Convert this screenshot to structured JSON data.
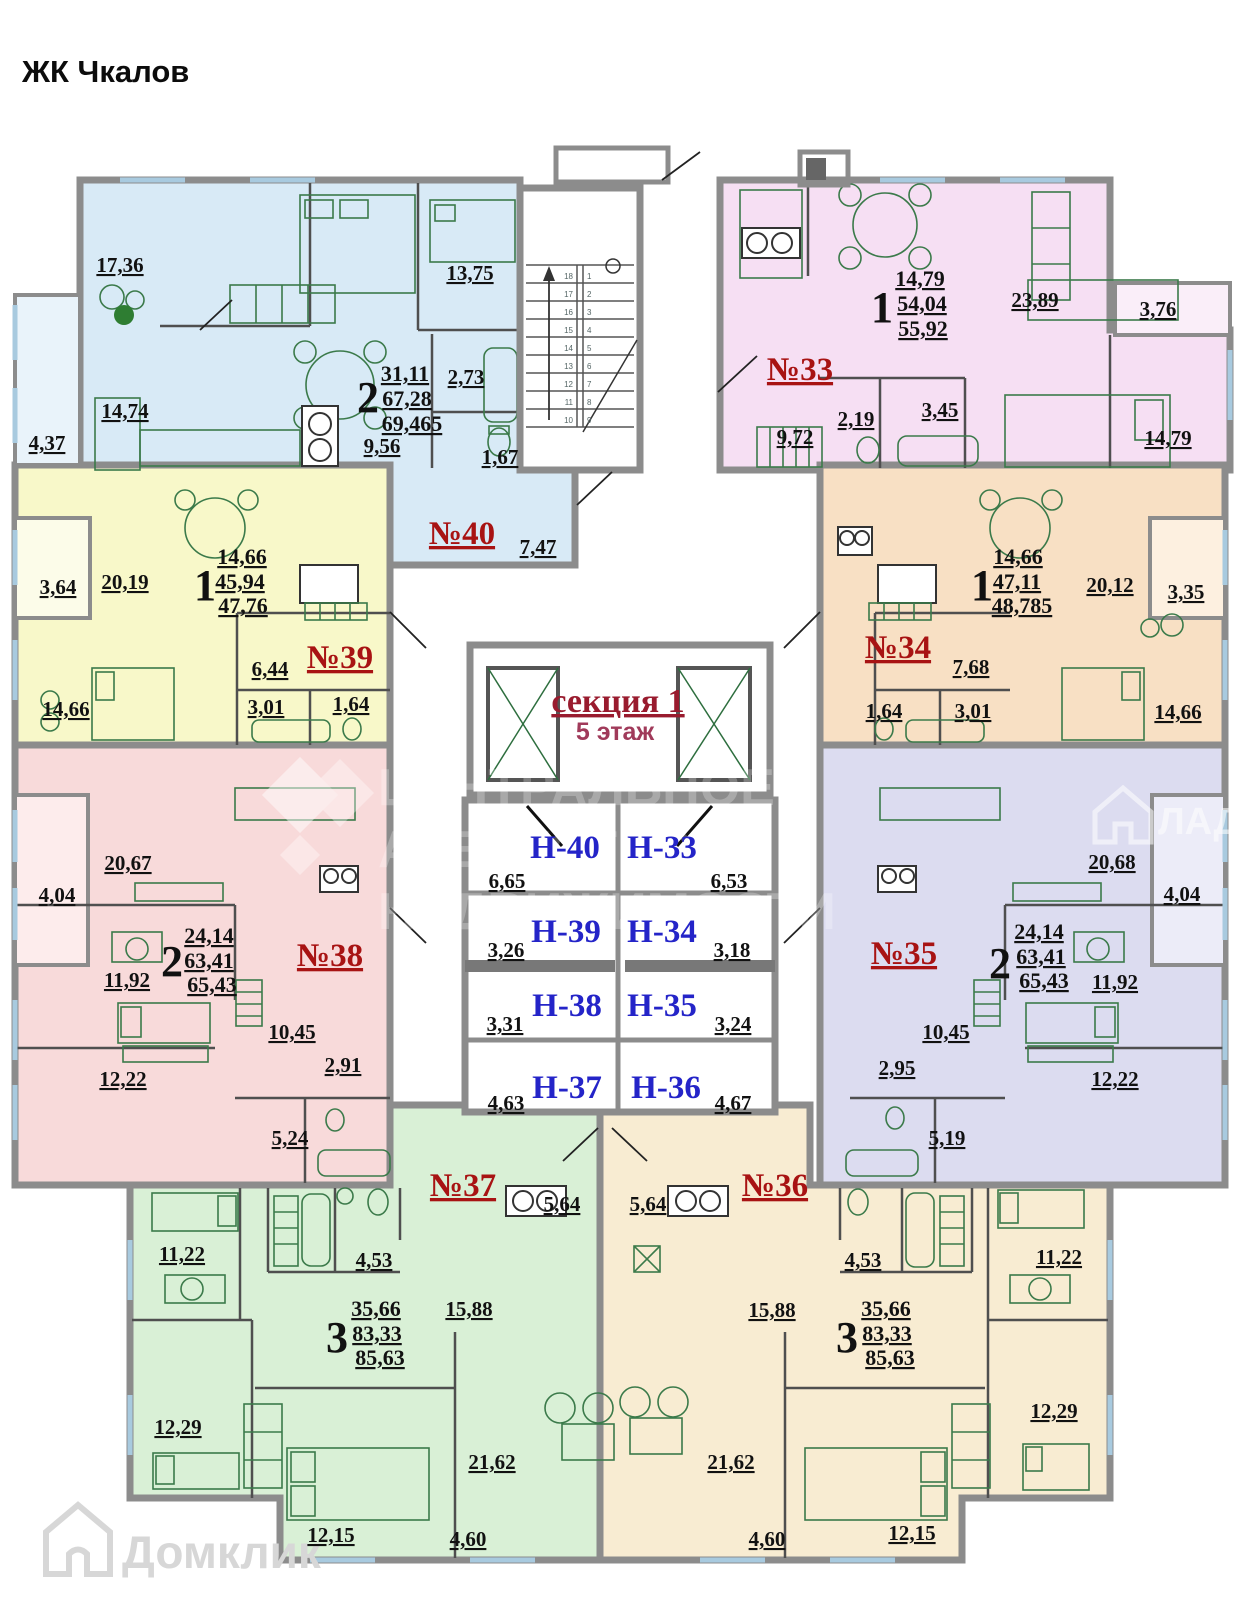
{
  "title": "ЖК Чкалов",
  "section": {
    "name": "секция 1",
    "floor": "5 этаж"
  },
  "colors": {
    "a40": "#d8eaf6",
    "a33": "#f6dff3",
    "a39": "#f8f8c9",
    "a34": "#f8e0c4",
    "a38": "#f8dada",
    "a35": "#dcdcf0",
    "a37": "#d9f0d6",
    "a36": "#f8ecd2",
    "b40": "#e9f3fa",
    "b33": "#faeef9",
    "b39": "#fcfce9",
    "b34": "#fdf0e0",
    "b38": "#fdecec",
    "b35": "#ececf8",
    "apartment_number": "#a81313",
    "storage_name": "#2424c8",
    "section_name": "#991b2e",
    "floor_label": "#a03a5a"
  },
  "apartments": {
    "a40": {
      "num": "№40",
      "type": "2",
      "stack": [
        "31,11",
        "67,28",
        "69,465"
      ],
      "rooms": [
        "17,36",
        "13,75",
        "14,74",
        "4,37",
        "9,56",
        "2,73",
        "1,67",
        "7,47"
      ]
    },
    "a33": {
      "num": "№33",
      "type": "1",
      "stack": [
        "14,79",
        "54,04",
        "55,92"
      ],
      "rooms": [
        "23,89",
        "3,76",
        "9,72",
        "2,19",
        "3,45",
        "14,79"
      ]
    },
    "a39": {
      "num": "№39",
      "type": "1",
      "stack": [
        "14,66",
        "45,94",
        "47,76"
      ],
      "rooms": [
        "3,64",
        "20,19",
        "6,44",
        "3,01",
        "1,64",
        "14,66"
      ]
    },
    "a34": {
      "num": "№34",
      "type": "1",
      "stack": [
        "14,66",
        "47,11",
        "48,785"
      ],
      "rooms": [
        "20,12",
        "3,35",
        "7,68",
        "1,64",
        "3,01",
        "14,66"
      ]
    },
    "a38": {
      "num": "№38",
      "type": "2",
      "stack": [
        "24,14",
        "63,41",
        "65,43"
      ],
      "rooms": [
        "20,67",
        "4,04",
        "11,92",
        "12,22",
        "10,45",
        "2,91",
        "5,24"
      ]
    },
    "a35": {
      "num": "№35",
      "type": "2",
      "stack": [
        "24,14",
        "63,41",
        "65,43"
      ],
      "rooms": [
        "20,68",
        "4,04",
        "11,92",
        "10,45",
        "2,95",
        "12,22",
        "5,19"
      ]
    },
    "a37": {
      "num": "№37",
      "type": "3",
      "stack": [
        "35,66",
        "83,33",
        "85,63"
      ],
      "rooms": [
        "11,22",
        "4,53",
        "15,88",
        "5,64",
        "12,29",
        "21,62",
        "12,15",
        "4,60"
      ]
    },
    "a36": {
      "num": "№36",
      "type": "3",
      "stack": [
        "35,66",
        "83,33",
        "85,63"
      ],
      "rooms": [
        "5,64",
        "15,88",
        "4,53",
        "11,22",
        "12,29",
        "21,62",
        "4,60",
        "12,15"
      ]
    }
  },
  "storages": [
    {
      "name": "Н-40",
      "area": "6,65"
    },
    {
      "name": "Н-33",
      "area": "6,53"
    },
    {
      "name": "Н-39",
      "area": "3,26"
    },
    {
      "name": "Н-34",
      "area": "3,18"
    },
    {
      "name": "Н-38",
      "area": "3,31"
    },
    {
      "name": "Н-35",
      "area": "3,24"
    },
    {
      "name": "Н-37",
      "area": "4,63"
    },
    {
      "name": "Н-36",
      "area": "4,67"
    }
  ],
  "stairs": {
    "down": [
      "18",
      "17",
      "16",
      "15",
      "14",
      "13",
      "12",
      "11",
      "10"
    ],
    "up": [
      "1",
      "2",
      "3",
      "4",
      "5",
      "6",
      "7",
      "8",
      "9"
    ]
  },
  "watermarks": {
    "center": [
      "ЦЕНТРАЛЬНОЕ",
      "АГЕНТСТВО",
      "НЕДВИЖИМОСТИ"
    ],
    "right": "ЛАДИС",
    "bottom": "Домклик"
  }
}
